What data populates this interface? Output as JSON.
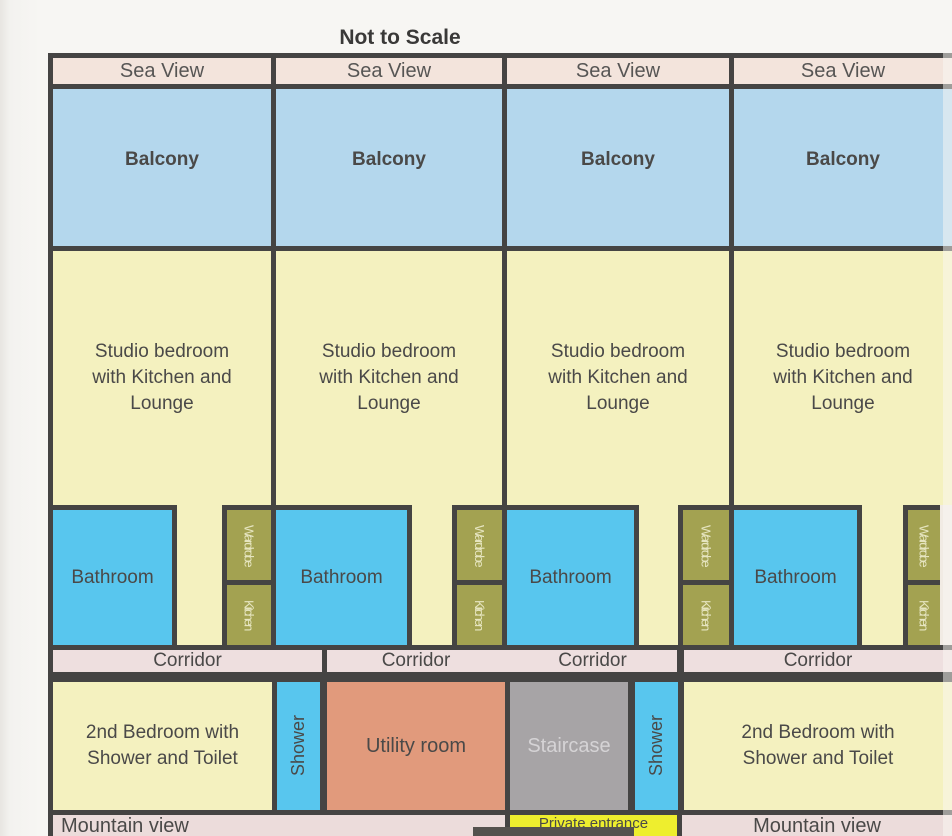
{
  "title": "Not to Scale",
  "unit_labels": {
    "sea_view": "Sea View",
    "balcony": "Balcony",
    "studio_lines": [
      "Studio bedroom",
      "with Kitchen and",
      "Lounge"
    ],
    "bathroom": "Bathroom",
    "wardrobe": "Wardrobe",
    "kitchen": "Kitchen"
  },
  "corridor": {
    "label": "Corridor"
  },
  "lower_floor": {
    "second_bedroom_lines": [
      "2nd Bedroom with",
      "Shower and Toilet"
    ],
    "shower": "Shower",
    "utility_room": "Utility room",
    "staircase": "Staircase"
  },
  "footer": {
    "mountain_view": "Mountain view",
    "private_entrance": "Private entrance"
  },
  "colors": {
    "border": "#454443",
    "sea_view_bg": "#f3e4dc",
    "balcony_bg": "#b4d7ed",
    "studio_bg": "#f4f1bf",
    "bathroom_bg": "#58c6ee",
    "wardrobe_kitchen_bg": "#a3a251",
    "corridor_bg": "#eedfdf",
    "utility_bg": "#e19a7c",
    "staircase_bg": "#a7a4a6",
    "shower_bg": "#58c6ee",
    "private_entrance_bg": "#eeee2e",
    "mountain_view_bg": "#ecdcdb",
    "text": "#4a4948"
  }
}
